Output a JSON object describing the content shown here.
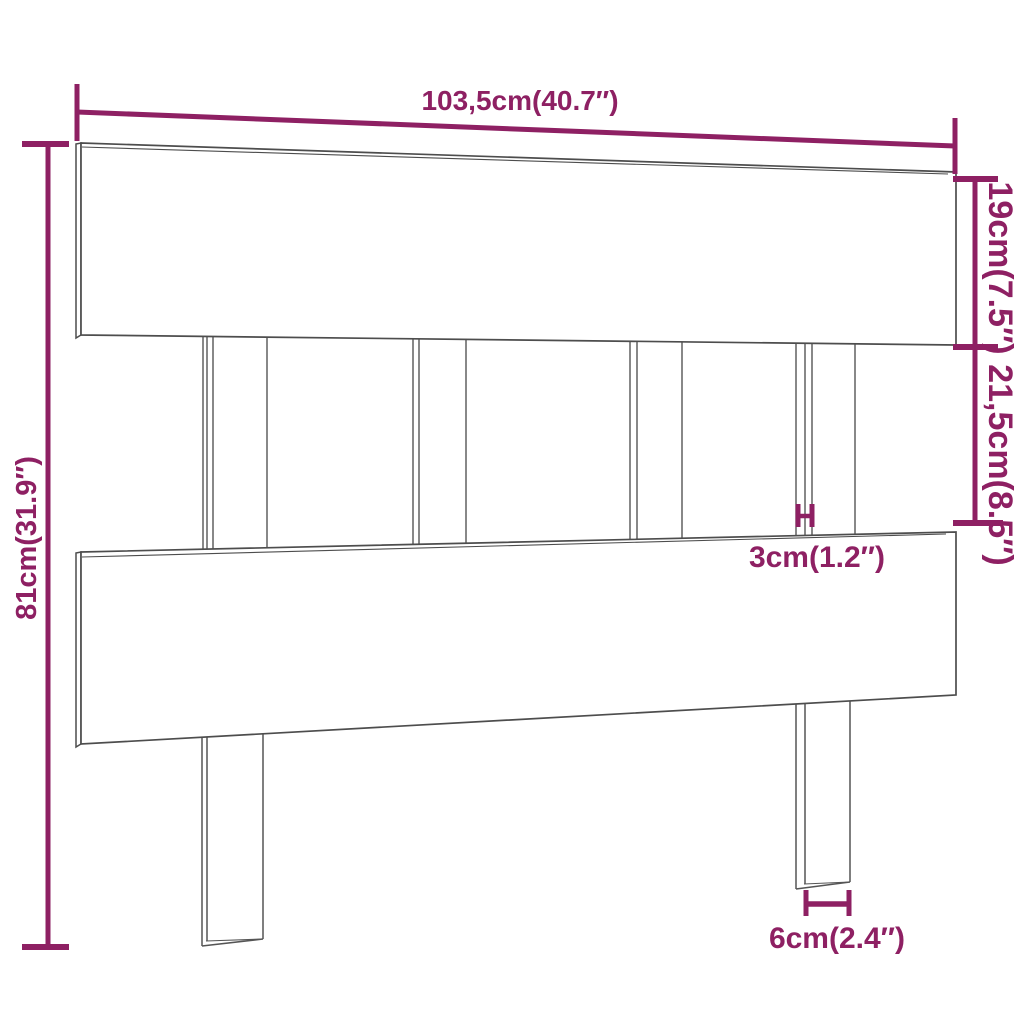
{
  "diagram": {
    "type": "furniture-dimension-diagram",
    "subject": "bed headboard with slats and two legs",
    "background_color": "#ffffff",
    "outline_color": "#4d4d4d",
    "dimension_color": "#8e2063",
    "dimensions": {
      "total_width": "103,5cm(40.7″)",
      "top_board_height": "19cm(7.5″)",
      "slat_section_height": "21,5cm(8.5″)",
      "total_height": "81cm(31.9″)",
      "slat_thickness": "3cm(1.2″)",
      "leg_width": "6cm(2.4″)"
    }
  }
}
